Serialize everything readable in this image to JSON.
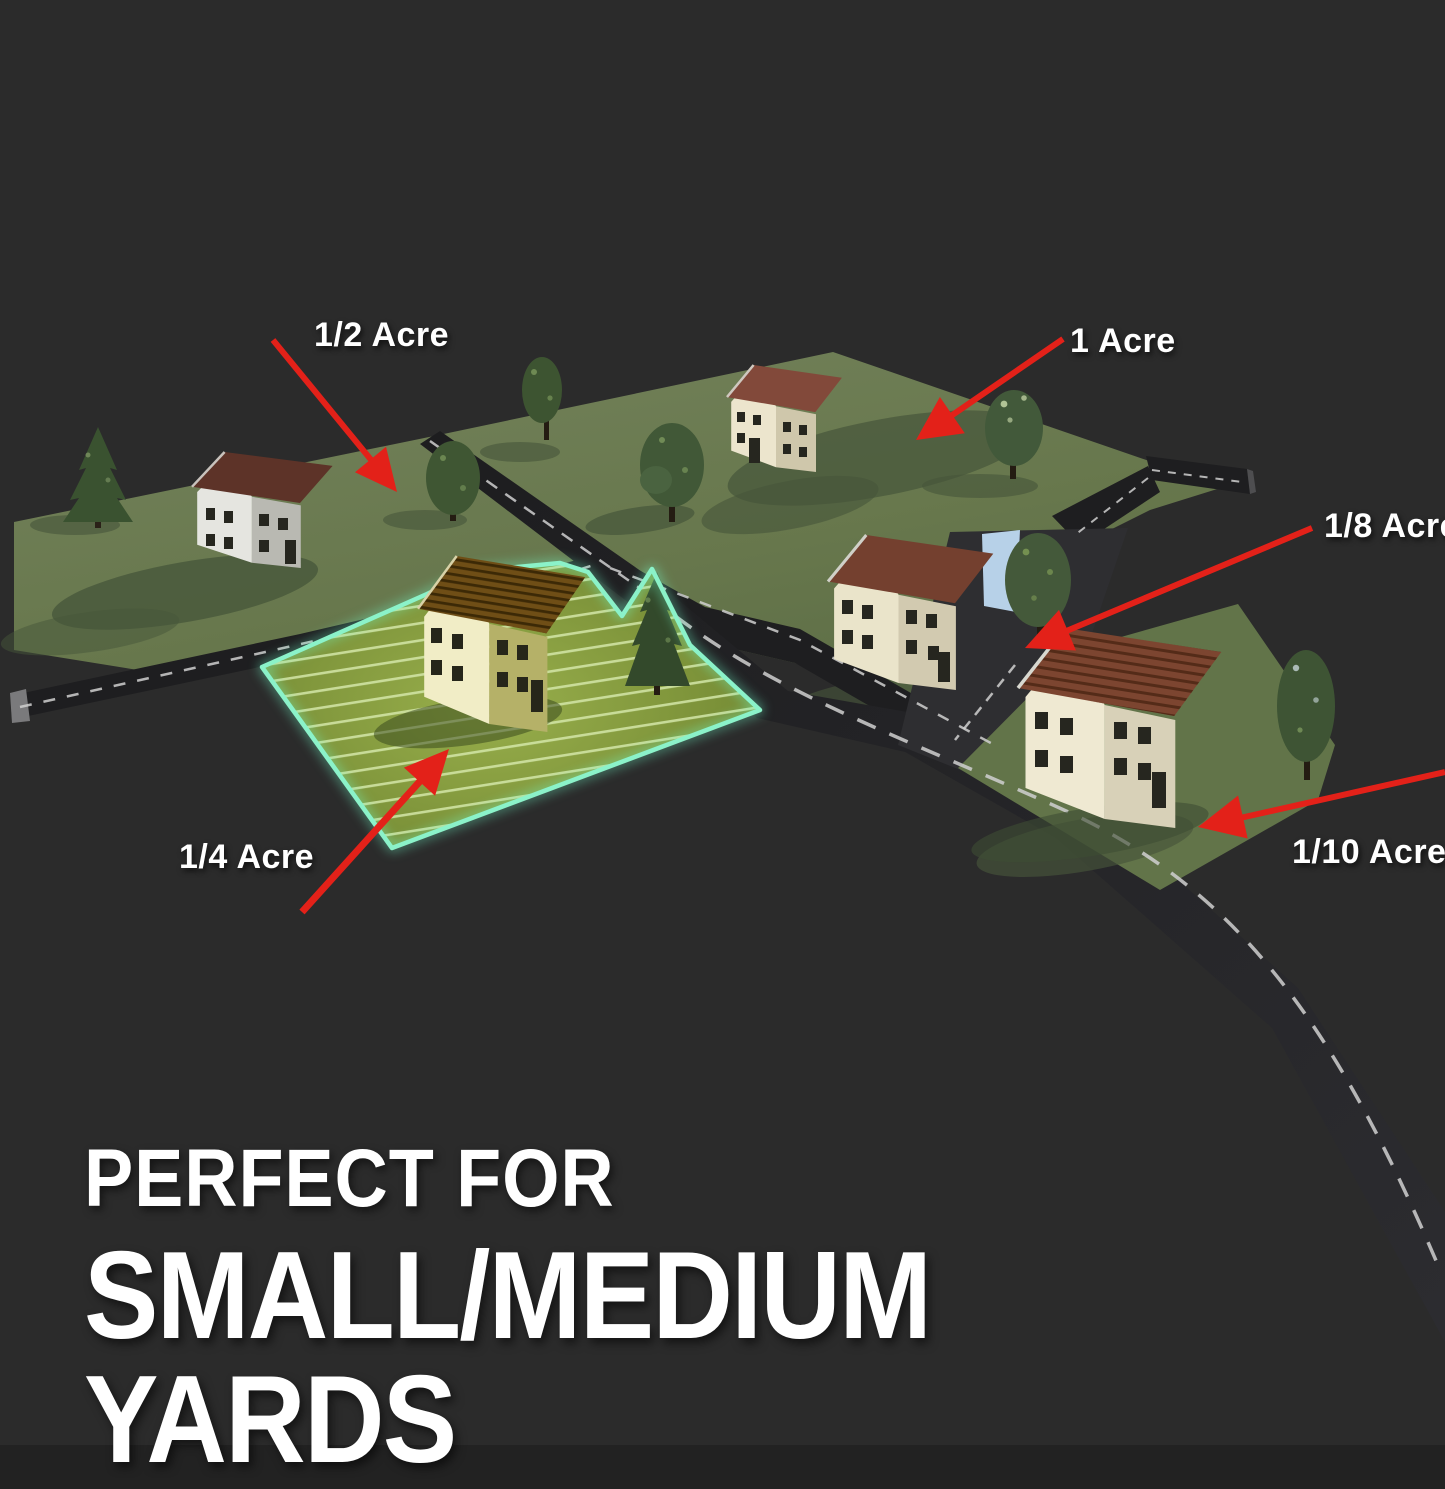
{
  "image_type": "acreage-comparison-infographic",
  "headline": {
    "line1": "PERFECT FOR",
    "line2": "SMALL/MEDIUM YARDS"
  },
  "lot_labels": [
    {
      "id": "half-acre",
      "text": "1/2 Acre"
    },
    {
      "id": "one-acre",
      "text": "1 Acre"
    },
    {
      "id": "eighth-acre",
      "text": "1/8 Acre"
    },
    {
      "id": "quarter-acre",
      "text": "1/4 Acre"
    },
    {
      "id": "tenth-acre",
      "text": "1/10 Acre"
    }
  ],
  "highlighted_lot": "1/4 Acre",
  "colors": {
    "background": "#2b2b2b",
    "arrow_red": "#e32119",
    "highlight_mint": "#8bf2c9",
    "lawn_green": "#66764b",
    "highlight_lawn": "#6e8430",
    "hatch_stripe": "#d4e6a8",
    "road_asphalt": "#1e1e20",
    "text_white": "#ffffff"
  }
}
